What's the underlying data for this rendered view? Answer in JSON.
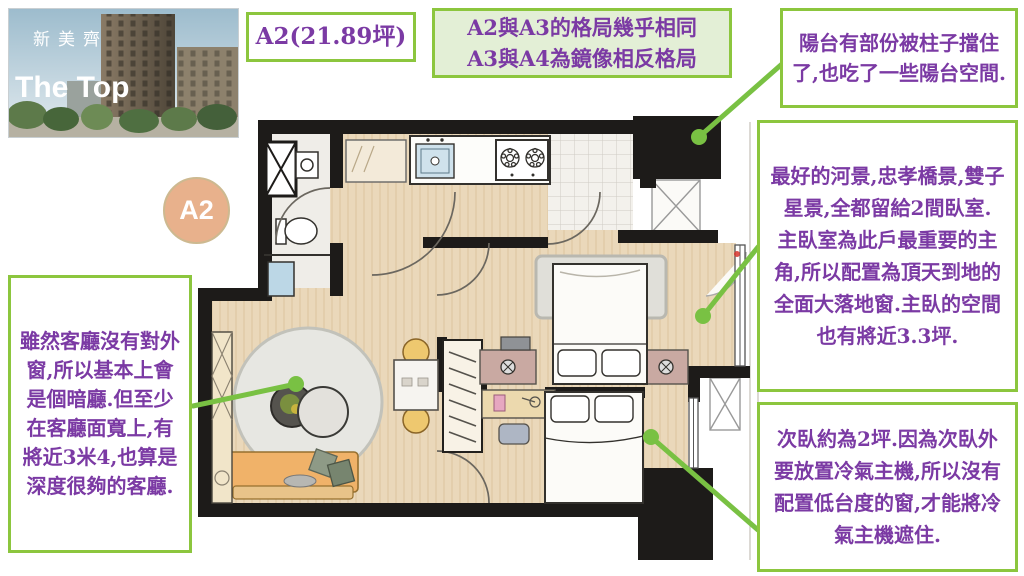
{
  "brand": {
    "name_cn": "新美齊",
    "name_en": "The Top"
  },
  "badge": {
    "label": "A2"
  },
  "boxes": {
    "unit_title": "A2(21.89坪)",
    "layout_note": {
      "line1": "A2與A3的格局幾乎相同",
      "line2": "A3與A4為鏡像相反格局"
    },
    "balcony_note": "陽台有部份被柱子擋住了,也吃了一些陽台空間.",
    "view_note_p1": "最好的河景,忠孝橋景,雙子星景,全都留給2間臥室.",
    "view_note_p2": "主臥室為此戶最重要的主角,所以配置為頂天到地的全面大落地窗.主臥的空間也有將近3.3坪.",
    "second_bedroom_note": "次臥約為2坪.因為次臥外要放置冷氣主機,所以沒有配置低台度的窗,才能將冷氣主機遮住.",
    "living_room_note": "雖然客廳沒有對外窗,所以基本上會是個暗廳.但至少在客廳面寬上,有將近3米4,也算是深度很夠的客廳."
  },
  "colors": {
    "box_border_green": "#8cc63e",
    "note_text_purple": "#7b3aa4",
    "layout_note_bg": "#e3efd6",
    "arrow_green": "#79c143",
    "badge_peach": "#e8b18c",
    "wall_black": "#1d1b19",
    "floor_wood": "#ead8ba"
  }
}
